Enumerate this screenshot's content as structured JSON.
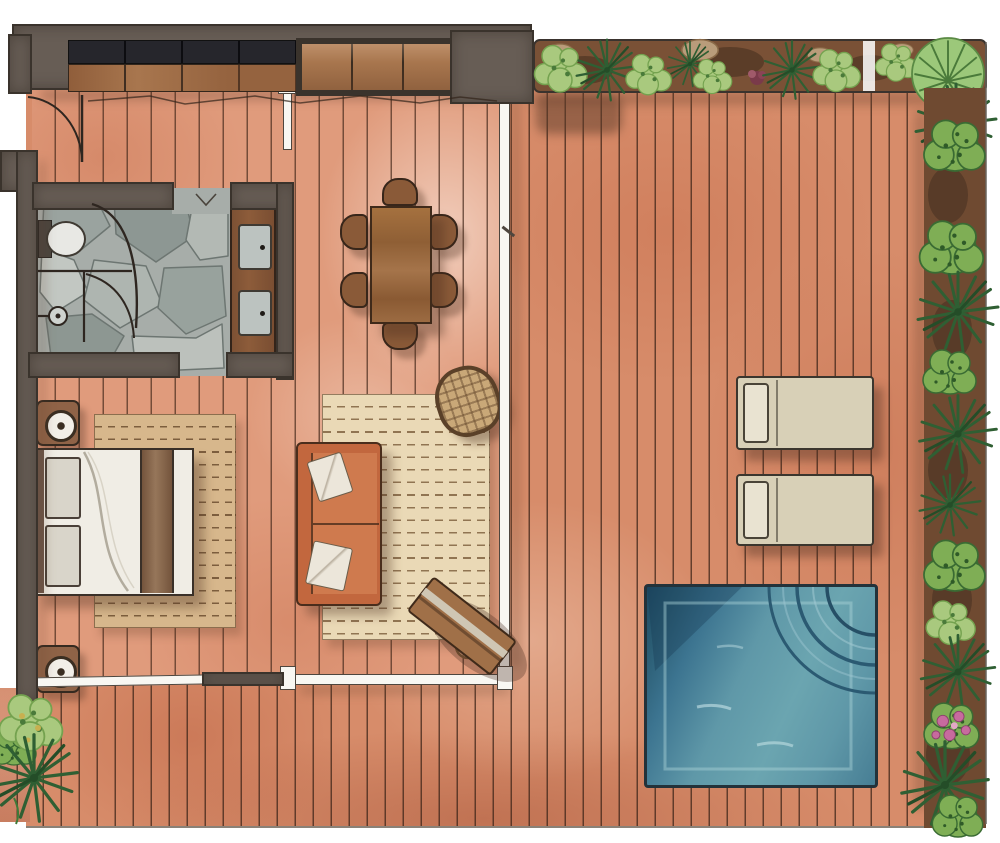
{
  "scene": {
    "kind": "hand-drawn watercolor architectural floor plan",
    "subject": "one-bedroom villa suite with private wooden deck, plunge pool and garden border",
    "rooms": [
      "entry",
      "wardrobe-hall",
      "bathroom",
      "bedroom",
      "living-area",
      "dining-area",
      "outdoor-deck",
      "garden-border"
    ],
    "furniture": {
      "storage": [
        "built-in-wardrobe",
        "wood-front-cabinet"
      ],
      "bathroom": [
        "toilet",
        "walk-in-curved-shower",
        "double-sink-vanity"
      ],
      "bedroom": [
        "double-bed",
        "nightstand-with-lamp",
        "nightstand-with-lamp",
        "area-rug"
      ],
      "living": [
        "two-seat-sofa",
        "throw-pillows",
        "area-rug",
        "round-wicker-chair",
        "angled-writing-desk",
        "desk-stool"
      ],
      "dining": {
        "table": "rectangular-wood-table",
        "chairs": 6
      },
      "deck": {
        "sun_loungers": 2,
        "plunge_pool": 1
      }
    },
    "garden": {
      "round_bushes": 8,
      "spiky_palms": 9,
      "fern_shrubs": 9,
      "flowering_bush_pink": 1,
      "planter_rocks": 4
    }
  },
  "palette": {
    "paper": "#ffffff",
    "line": "#2e2620",
    "wall": "#675d55",
    "walldark": "#3a332c",
    "closetblack": "#26262c",
    "cabwood": "#a8764e",
    "deck": "#d78c6a",
    "decklight": "#eeb497",
    "deckdark": "#bf6c49",
    "plank": "#553626",
    "interior": "#e09b7c",
    "stone": "#a7ada9",
    "stonedark": "#6d7672",
    "vanity": "#8d5c3a",
    "sink": "#bcc3c0",
    "rugbed": "#d7b78c",
    "ruglive": "#ead9b6",
    "rugdash": "#8a6a45",
    "sofa": "#c2673e",
    "sofaline": "#4a2d1c",
    "cushion": "#ece6da",
    "duvet": "#f0ede5",
    "pillow": "#d9d5ca",
    "runner": "#86654a",
    "stand": "#8f6347",
    "wicker": "#c9a878",
    "wickerline": "#6a4d30",
    "table": "#9c6b42",
    "chair": "#8a5a38",
    "lounger": "#d8d0b7",
    "loungerpillow": "#e9e3d1",
    "pool": "#5f98a8",
    "pooldark": "#2b5d74",
    "poolnavy": "#1e4a63",
    "poollight": "#79afba",
    "soil": "#6f4a31",
    "soildark": "#46301f",
    "rock": "#b99c7a",
    "leaflight": "#a9c97e",
    "leafmid": "#74a24f",
    "leafbush": "#7fae55",
    "leafdark": "#2f5f33",
    "leafdeep": "#244d28",
    "pink": "#c76a9e",
    "glass": "#f8f7f2"
  }
}
